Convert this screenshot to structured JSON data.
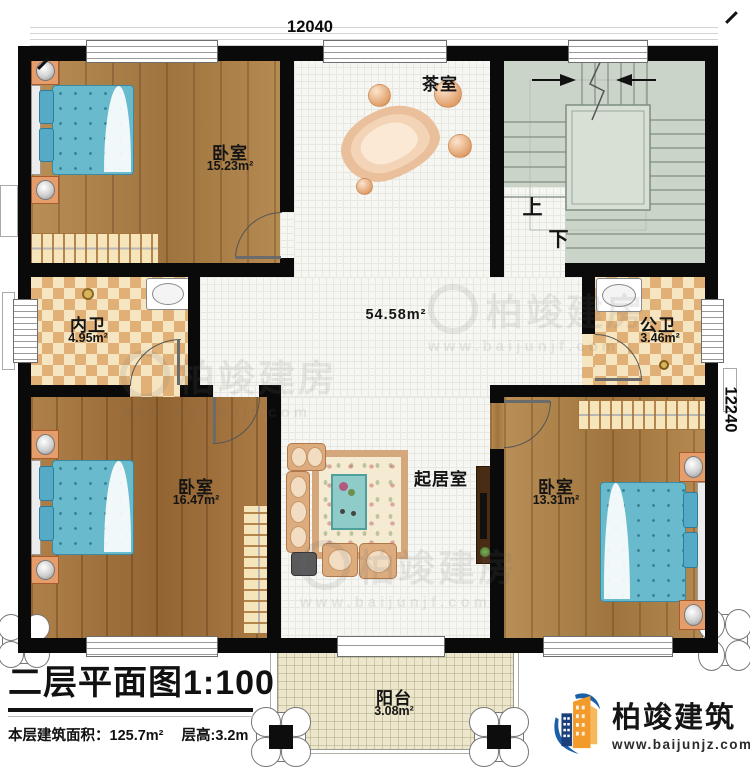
{
  "plan": {
    "dimensions": {
      "top": "12040",
      "right": "12240"
    },
    "rooms": {
      "bedroom_top_left": {
        "name": "卧室",
        "area": "15.23m²"
      },
      "tea_room": {
        "name": "茶室"
      },
      "stairwell": {
        "up": "上",
        "down": "下"
      },
      "inner_bathroom": {
        "name": "内卫",
        "area": "4.95m²"
      },
      "public_bathroom": {
        "name": "公卫",
        "area": "3.46m²"
      },
      "hall": {
        "area": "54.58m²"
      },
      "living_room": {
        "name": "起居室"
      },
      "bedroom_bottom_left": {
        "name": "卧室",
        "area": "16.47m²"
      },
      "bedroom_bottom_right": {
        "name": "卧室",
        "area": "13.31m²"
      },
      "balcony": {
        "name": "阳台",
        "area": "3.08m²"
      }
    }
  },
  "title_block": {
    "title": "二层平面图1:100",
    "area_label": "本层建筑面积：125.7m²",
    "height_label": "层高:3.2m"
  },
  "logo": {
    "company": "柏竣建筑",
    "website": "www.baijunjz.com"
  },
  "watermark": {
    "brand": "柏竣建房",
    "website": "www.baijunjf.com"
  },
  "colors": {
    "wall": "#0a0a0a",
    "wood": "#ab7f46",
    "tile": "#f6f6f3",
    "checker_dark": "#e0b077",
    "checker_light": "#f5e5c0",
    "stair_floor": "#cbd4c9",
    "balcony_floor": "#ece6cc",
    "bed": "#69bacd",
    "furniture_orange": "#e59e6b",
    "logo_blue": "#1a5fa8",
    "logo_orange": "#f29b2a"
  }
}
